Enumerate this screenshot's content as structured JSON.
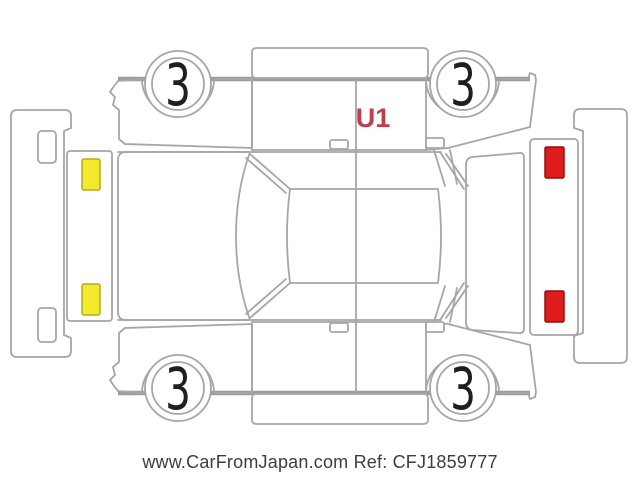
{
  "diagram": {
    "type": "vehicle-inspection-damage-diagram",
    "damage_code": "U1",
    "wheels": [
      {
        "position": "top-left",
        "label": "3"
      },
      {
        "position": "top-right",
        "label": "3"
      },
      {
        "position": "bottom-left",
        "label": "3"
      },
      {
        "position": "bottom-right",
        "label": "3"
      }
    ],
    "markers": {
      "front_panel": {
        "shape": "rect",
        "count": 2
      },
      "rear_panel": {
        "shape": "rect",
        "count": 2
      }
    }
  },
  "colors": {
    "outline": "#a6a6a6",
    "outline_strong": "#9c9c9c",
    "marker_yellow": "#f3ea2d",
    "marker_red": "#dd1d1d",
    "damage_code_text": "#c23b4f",
    "wheel_text": "#1f1f1f",
    "watermark_text": "#3d3d3d"
  },
  "watermark": {
    "text": "www.CarFromJapan.com Ref: CFJ1859777"
  }
}
